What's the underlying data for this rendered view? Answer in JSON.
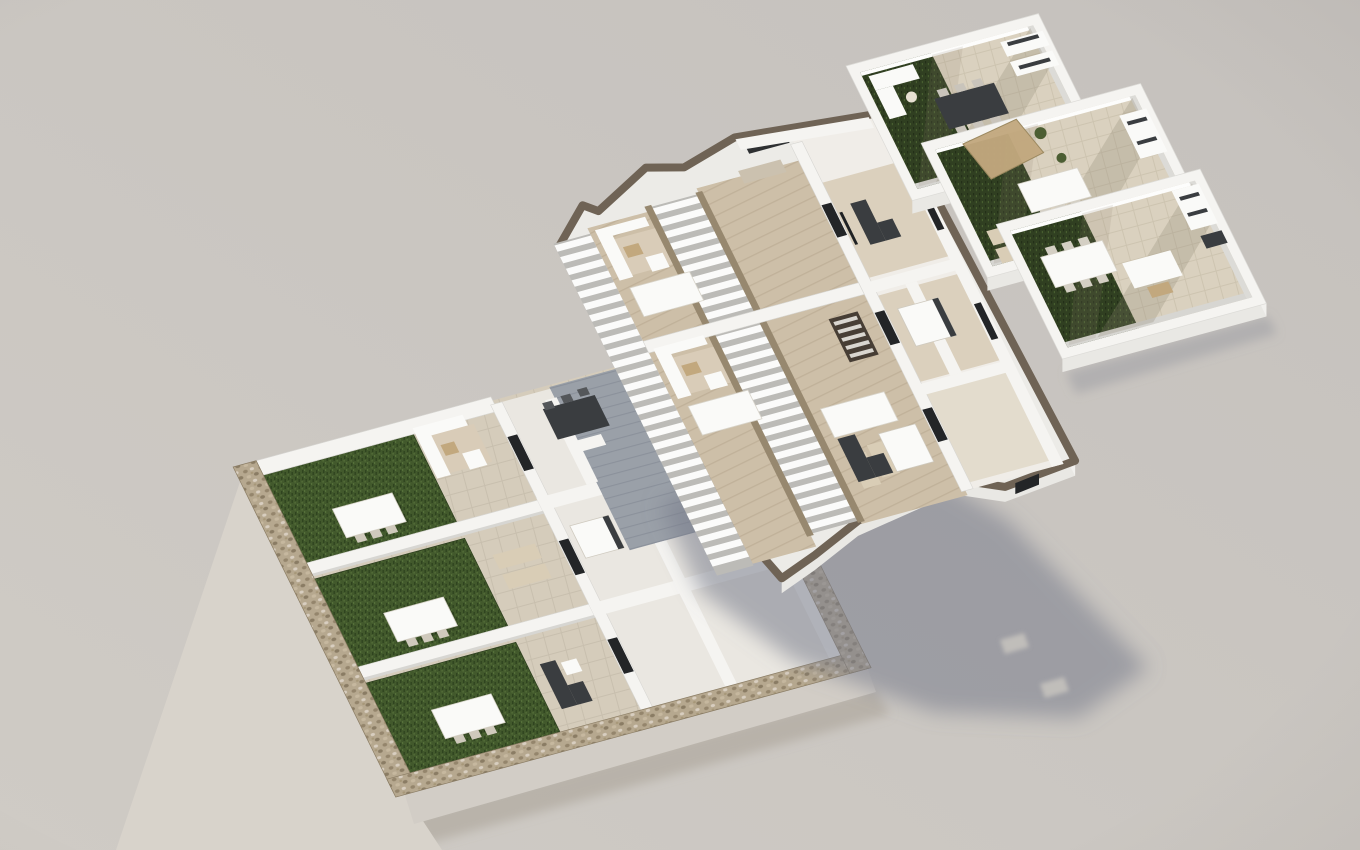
{
  "scene": {
    "type": "exploded-isometric-floorplan-render",
    "description": "3D architectural visualization of a three-level apartment building shown as separated floor plates",
    "light_direction": "upper-left",
    "shadow_direction": "lower-right",
    "floors": [
      {
        "id": "ground-floor",
        "name": "ground-floor-with-private-gardens",
        "gardens": 3,
        "garden_dining_tables": 3,
        "stone_perimeter": true,
        "shaded_courtyard": true,
        "units": 3
      },
      {
        "id": "middle-floor",
        "name": "first-floor-with-staircases",
        "staircases": 2,
        "terrace_lounges": 2,
        "internal_stair": true,
        "rooms": true,
        "drop_shadow": true
      },
      {
        "id": "top-floor",
        "name": "roof-terraces",
        "terraces": 3,
        "pergola": true,
        "grass_strips": 3
      }
    ]
  },
  "palette": {
    "bg_top": "#c5c1bd",
    "bg_bottom": "#cfcbc5",
    "wall_white": "#f5f4f1",
    "wall_light": "#fdfdfc",
    "wall_shade": "#d7d6d2",
    "wall_dark": "#c4c3c0",
    "slab_edge": "#e9e8e4",
    "slab_edge_light": "#f2f1ee",
    "floor_patio": "#d5ccbb",
    "floor_room": "#ecc",
    "floor_room_base": "#eae7e1",
    "floor_wood": "#cdbfa8",
    "floor_wood_light": "#dbd0bd",
    "floor_hall": "#e3dccd",
    "grass_base": "#42592c",
    "grass_dark": "#2f441f",
    "grass_light": "#55703a",
    "roof_grass_base": "#303f21",
    "roof_grass_dark": "#232f18",
    "roof_grass_light": "#475d2f",
    "stone_base": "#b6a88f",
    "stone_dark": "#8a7c64",
    "stone_mid": "#94856c",
    "stone_chip": "#d8cec0",
    "stone_face_west": "#d8d3cb",
    "stone_face_south": "#d2cdc6",
    "taupe": "#6f6355",
    "taupe_light": "#97886f",
    "tread_bg": "#bcbbb7",
    "tread_white": "#fbfbfa",
    "courtyard": "#9aa0a8",
    "courtyard_line": "#8b919b",
    "tile_base": "#dad1bf",
    "tile_line": "#cdc4b0",
    "shadow_drop": "#787b8a",
    "shadow_contact": "#a59d92",
    "shadow_slit": "#c7c3be",
    "shadow_top": "#8f909b",
    "shadow_diag": "#8d8371",
    "furn_dark": "#3a3d40",
    "furn_white": "#fafaf8",
    "furn_tan": "#c2a87e",
    "furn_beige": "#d9cdb6",
    "rug": "#d9ccb8",
    "window_dark": "#232527",
    "plant_green": "#4c5e33"
  }
}
